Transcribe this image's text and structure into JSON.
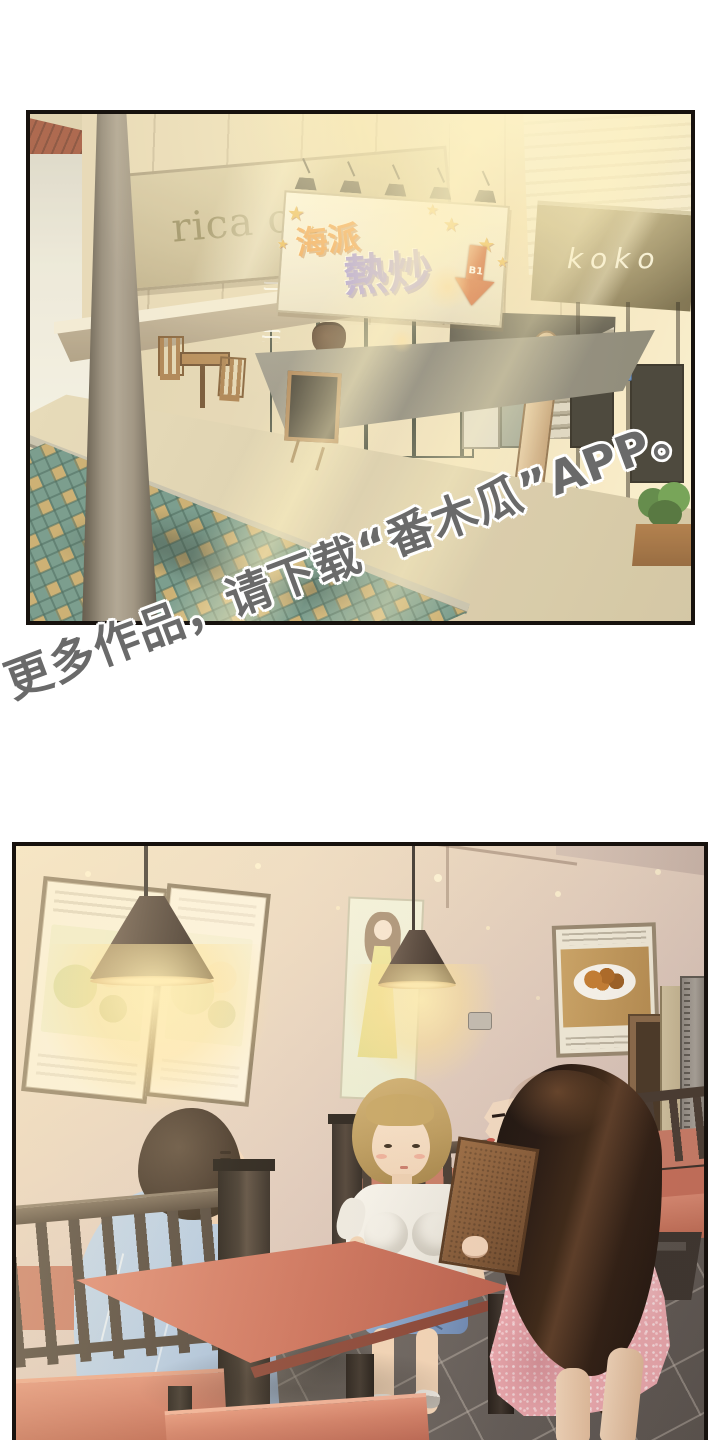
{
  "page": {
    "kind": "webtoon comic page",
    "width_px": 720,
    "height_px": 1440,
    "background_color": "#ffffff",
    "panel_border_color": "#17120e"
  },
  "watermark": {
    "text": "更多作品，请下载“番木瓜”APP。",
    "color": "#6a6a6a",
    "outline_color": "#ffffff",
    "angle_deg": -20.5
  },
  "panels": {
    "street": {
      "description": "sunlit street with storefronts",
      "cafe_sign": "rica coffee",
      "hotpot_sign": {
        "word1": "海派",
        "word2": "熱炒",
        "word1_color": "#f09c48",
        "word2_color": "#9d8fdc",
        "arrow_label": "B1",
        "arrow_color": "#c9572e",
        "star_glyph": "★"
      },
      "koko_sign": "koko",
      "door_plate": "202",
      "palette": {
        "road": "#689288",
        "road_squares": "#c6a86a",
        "sidewalk": "#d9cdae",
        "sunlight": "#fdf5d8",
        "pole": "#8d8477"
      }
    },
    "restaurant": {
      "description": "restaurant interior with booths, two women and seated man",
      "palette": {
        "wall": "#e0cbbe",
        "booth_wood": "#3f352c",
        "seat": "#cc705a",
        "lamp_glow": "#ffeeb4",
        "floor": "#6b6460",
        "pink_dress": "#eca9af",
        "blue_shirt": "#b3c9e2",
        "jean_shorts": "#7d9cc6",
        "blonde_hair": "#bd9c5e",
        "dark_hair": "#241711"
      }
    }
  }
}
